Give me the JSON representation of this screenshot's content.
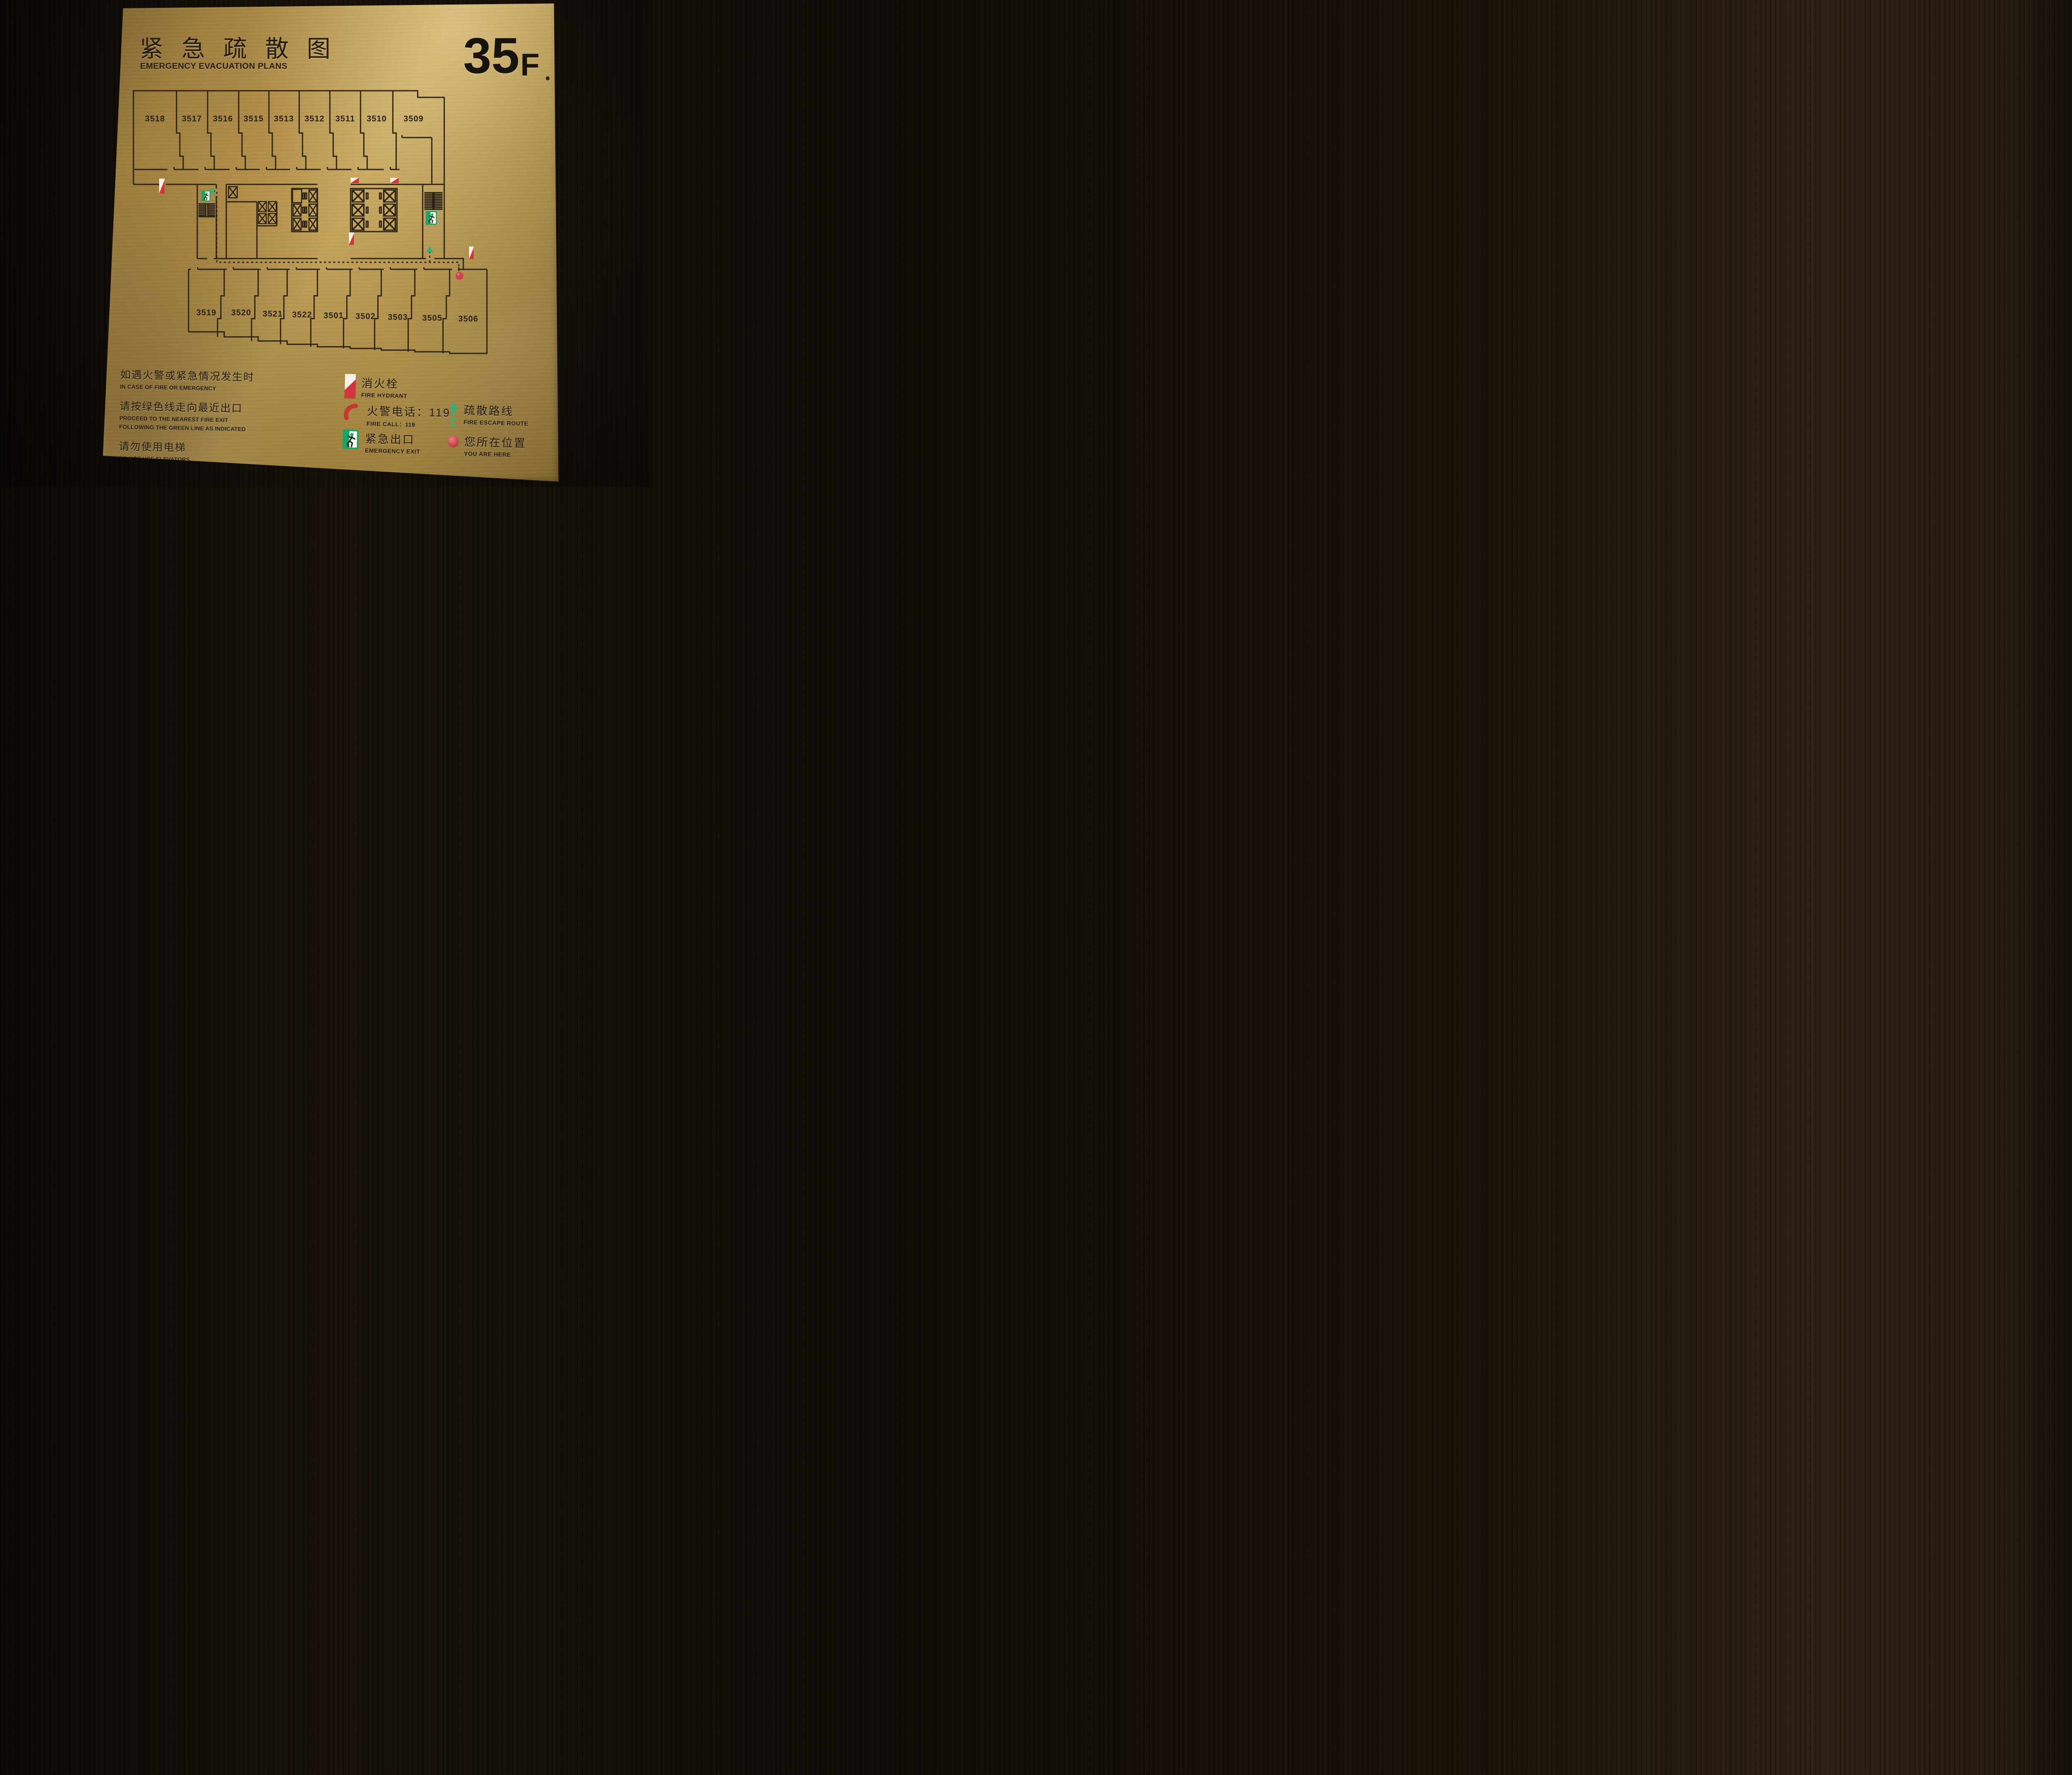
{
  "header": {
    "title_cn": "紧 急 疏 散 图",
    "title_en": "EMERGENCY EVACUATION PLANS",
    "floor_number": "35",
    "floor_suffix": "F"
  },
  "plan": {
    "top_rooms": [
      "3518",
      "3517",
      "3516",
      "3515",
      "3513",
      "3512",
      "3511",
      "3510",
      "3509"
    ],
    "bottom_rooms": [
      "3519",
      "3520",
      "3521",
      "3522",
      "3501",
      "3502",
      "3503",
      "3505",
      "3506"
    ]
  },
  "instructions": [
    {
      "cn": "如遇火警或紧急情况发生时",
      "en": "IN CASE OF FIRE OR EMERGENCY"
    },
    {
      "cn": "请按绿色线走向最近出口",
      "en": "PROCEED TO THE NEAREST FIRE EXIT FOLLOWING THE GREEN LINE AS INDICATED"
    },
    {
      "cn": "请勿使用电梯",
      "en": "DO NOT USE ELEVATORS"
    }
  ],
  "legend": [
    {
      "icon": "fire-hydrant",
      "cn": "消火栓",
      "en": "FIRE HYDRANT"
    },
    {
      "icon": "fire-call",
      "cn": "火警电话：119",
      "en": "FIRE CALL：119"
    },
    {
      "icon": "emergency-exit",
      "cn": "紧急出口",
      "en": "EMERGENCY EXIT"
    },
    {
      "icon": "escape-route",
      "cn": "疏散路线",
      "en": "FIRE ESCAPE ROUTE"
    },
    {
      "icon": "you-are-here",
      "cn": "您所在位置",
      "en": "YOU ARE HERE"
    }
  ],
  "colors": {
    "brass": "#b28f49",
    "engraving": "#241e14",
    "route_green": "#2db27c",
    "exit_green": "#18a568",
    "alarm_red": "#d4353c",
    "here_red": "#cc4450",
    "wood": "#17110a"
  }
}
